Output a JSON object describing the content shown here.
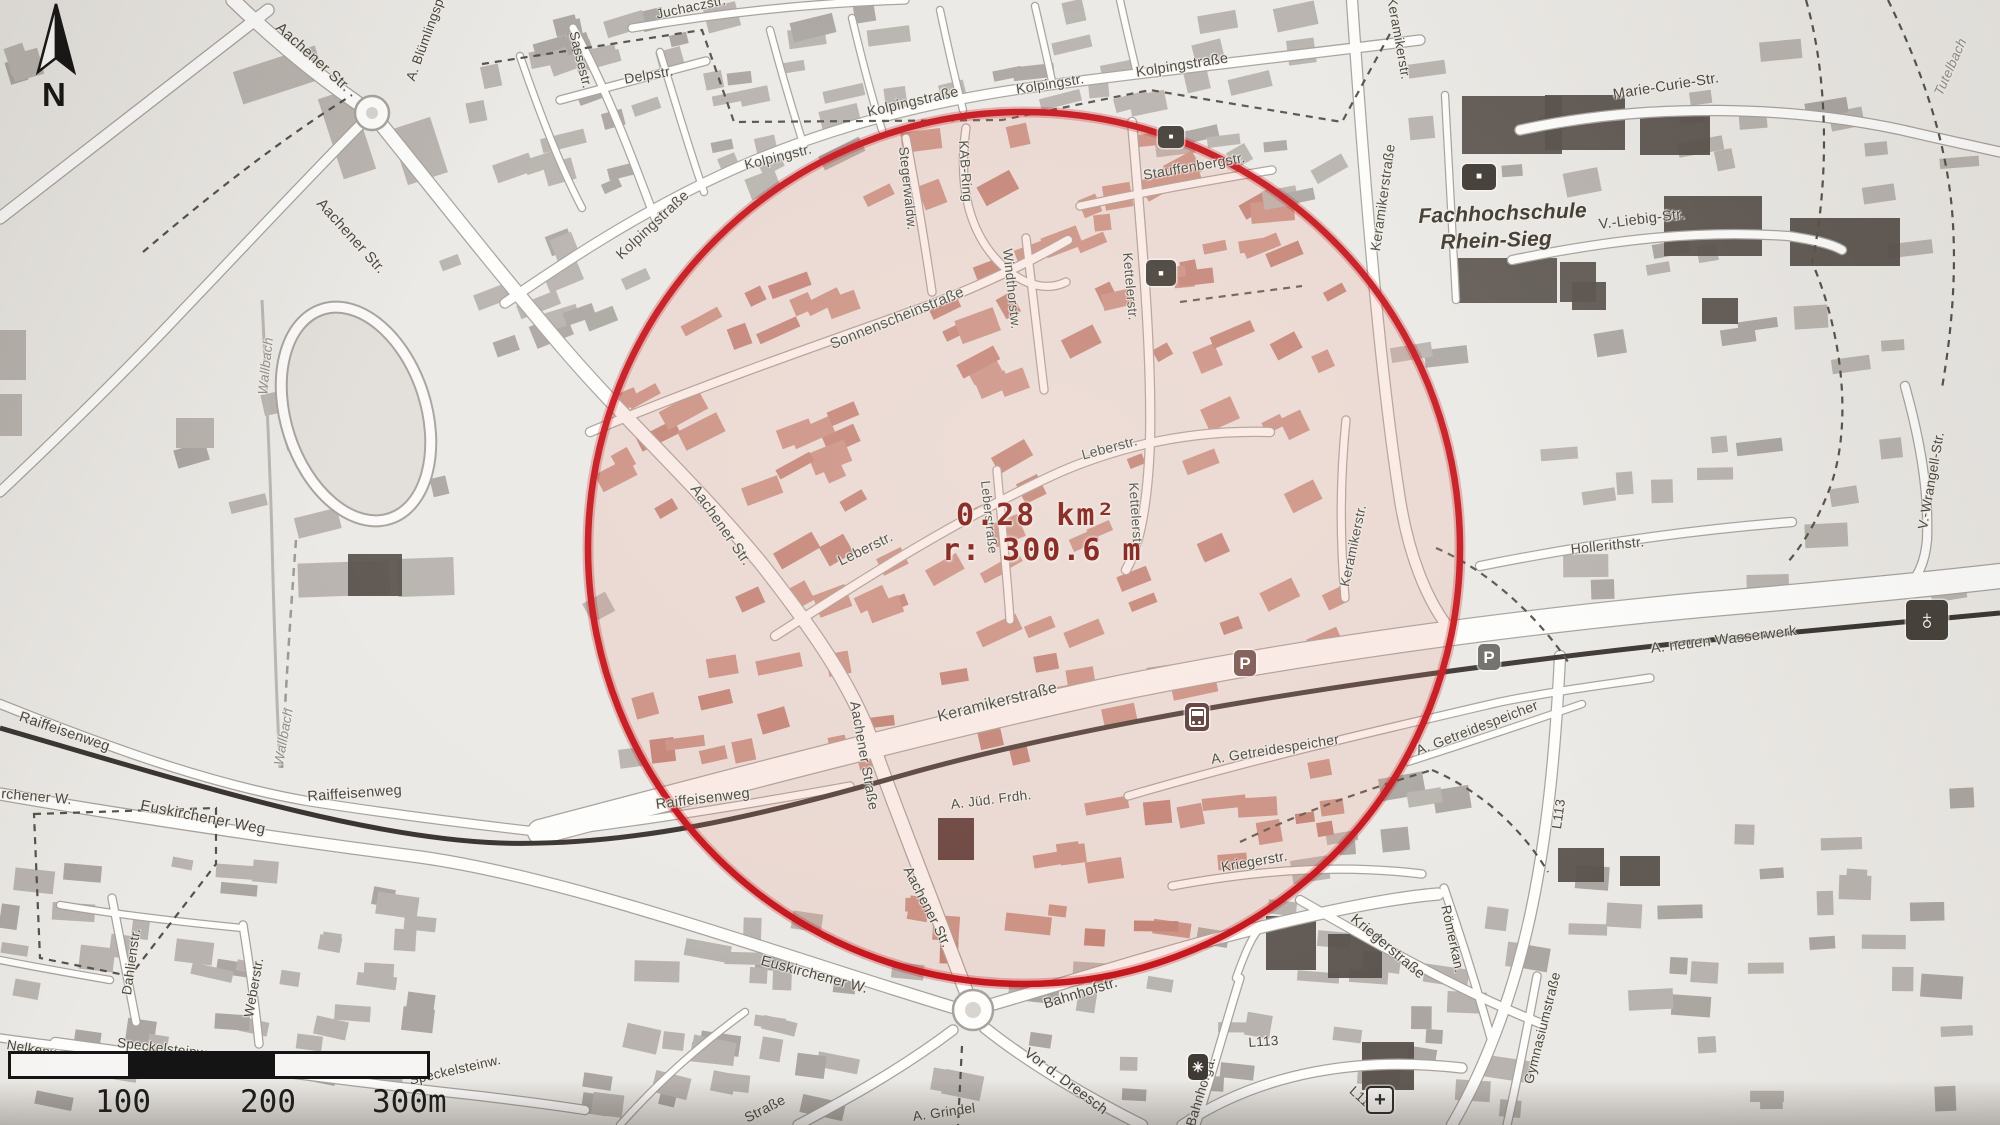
{
  "measurement": {
    "area": "0.28 km²",
    "radius": "r: 300.6 m"
  },
  "scale_bar": {
    "labels": [
      "100",
      "200",
      "300m"
    ]
  },
  "compass": {
    "label": "N"
  },
  "colors": {
    "circle_stroke": "#c4151c",
    "circle_tint": "rgba(231,138,115,0.17)",
    "measurement_text": "#7c130e",
    "railway": "#3b3531",
    "road_casing": "#a8a29c",
    "building_inside": "#c79387",
    "building_outside": "#b8b3ae",
    "building_dark": "#57504a"
  },
  "map_labels": [
    {
      "t": "Aachener Str.",
      "x": 283,
      "y": 20,
      "r": 42,
      "s": 15
    },
    {
      "t": "A. Blümlingspd.",
      "x": 404,
      "y": 78,
      "r": -70,
      "s": 13.5
    },
    {
      "t": "Juchaczstr.",
      "x": 655,
      "y": 8,
      "r": -12,
      "s": 13.5
    },
    {
      "t": "Sassestr.",
      "x": 580,
      "y": 30,
      "r": 76,
      "s": 13.5
    },
    {
      "t": "Delpstr.",
      "x": 623,
      "y": 72,
      "r": -10,
      "s": 14
    },
    {
      "t": "Aachener Str.",
      "x": 325,
      "y": 196,
      "r": 48,
      "s": 15
    },
    {
      "t": "Kolpingstraße",
      "x": 614,
      "y": 252,
      "r": -43,
      "s": 14.5
    },
    {
      "t": "Kolpingstr.",
      "x": 743,
      "y": 158,
      "r": -14,
      "s": 14
    },
    {
      "t": "Kolpingstraße",
      "x": 866,
      "y": 106,
      "r": -13,
      "s": 14.5
    },
    {
      "t": "Kolpingstr.",
      "x": 1015,
      "y": 82,
      "r": -9,
      "s": 14
    },
    {
      "t": "Kolpingstraße",
      "x": 1135,
      "y": 66,
      "r": -9,
      "s": 14.5
    },
    {
      "t": "Stegerwaldw.",
      "x": 910,
      "y": 146,
      "r": 84,
      "s": 13.5
    },
    {
      "t": "KAB-Ring",
      "x": 970,
      "y": 140,
      "r": 86,
      "s": 13.5
    },
    {
      "t": "Windthorstw.",
      "x": 1014,
      "y": 248,
      "r": 84,
      "s": 13.5
    },
    {
      "t": "Kettelerstr.",
      "x": 1134,
      "y": 252,
      "r": 85,
      "s": 13.5
    },
    {
      "t": "Stauffenbergstr.",
      "x": 1142,
      "y": 168,
      "r": -10,
      "s": 14
    },
    {
      "t": "Sonnenscheinstraße",
      "x": 828,
      "y": 338,
      "r": -22,
      "s": 15
    },
    {
      "t": "Leberstr.",
      "x": 1080,
      "y": 448,
      "r": -15,
      "s": 14
    },
    {
      "t": "Leberstraße",
      "x": 992,
      "y": 480,
      "r": 84,
      "s": 13
    },
    {
      "t": "Kettelerstr.",
      "x": 1140,
      "y": 482,
      "r": 86,
      "s": 13.5
    },
    {
      "t": "Leberstr.",
      "x": 836,
      "y": 556,
      "r": -26,
      "s": 14.5
    },
    {
      "t": "Aachener Str.",
      "x": 700,
      "y": 482,
      "r": 55,
      "s": 15
    },
    {
      "t": "Keramikerstr.",
      "x": 1338,
      "y": 585,
      "r": -78,
      "s": 13.5
    },
    {
      "t": "Keramikerstraße",
      "x": 936,
      "y": 710,
      "r": -14,
      "s": 16
    },
    {
      "t": "Keramikerstraße",
      "x": 1368,
      "y": 250,
      "r": -82,
      "s": 14
    },
    {
      "t": "Keramikerstr.",
      "x": 1398,
      "y": -4,
      "r": 80,
      "s": 13.5
    },
    {
      "t": "Marie-Curie-Str.",
      "x": 1612,
      "y": 88,
      "r": -9,
      "s": 14.5
    },
    {
      "t": "V.-Liebig-Str.",
      "x": 1598,
      "y": 218,
      "r": -7,
      "s": 14.5
    },
    {
      "t": "Tutelbach",
      "x": 1932,
      "y": 92,
      "r": -66,
      "s": 13.5,
      "c": "stream"
    },
    {
      "t": "Fachhochschule",
      "x": 1418,
      "y": 206,
      "r": -2,
      "s": 21,
      "c": "fh"
    },
    {
      "t": "Rhein-Sieg",
      "x": 1440,
      "y": 232,
      "r": -2,
      "s": 21,
      "c": "fh"
    },
    {
      "t": "Hollerithstr.",
      "x": 1570,
      "y": 542,
      "r": -6,
      "s": 14
    },
    {
      "t": "V.-Wrangell-Str.",
      "x": 1916,
      "y": 528,
      "r": -80,
      "s": 13.5
    },
    {
      "t": "A. neuen Wasserwerk",
      "x": 1650,
      "y": 642,
      "r": -7,
      "s": 14.5
    },
    {
      "t": "Wallbach",
      "x": 256,
      "y": 394,
      "r": -84,
      "s": 13.5,
      "c": "stream"
    },
    {
      "t": "Wallbach",
      "x": 272,
      "y": 764,
      "r": -80,
      "s": 13.5,
      "c": "stream"
    },
    {
      "t": "Raiffeisenweg",
      "x": 22,
      "y": 710,
      "r": 19,
      "s": 14.5
    },
    {
      "t": "Raiffeisenweg",
      "x": 307,
      "y": 790,
      "r": -4,
      "s": 14.5
    },
    {
      "t": "Raiffeisenweg",
      "x": 655,
      "y": 798,
      "r": -7,
      "s": 14.5
    },
    {
      "t": "Euskirchener Weg",
      "x": 142,
      "y": 798,
      "r": 11,
      "s": 15
    },
    {
      "t": "rchener W.",
      "x": 2,
      "y": 786,
      "r": 5,
      "s": 14
    },
    {
      "t": "Euskirchener W.",
      "x": 763,
      "y": 954,
      "r": 15,
      "s": 14.5
    },
    {
      "t": "Aachener Straße",
      "x": 862,
      "y": 700,
      "r": 80,
      "s": 14
    },
    {
      "t": "Aachener Str.",
      "x": 914,
      "y": 864,
      "r": 63,
      "s": 14
    },
    {
      "t": "A. Jüd. Frdh.",
      "x": 950,
      "y": 798,
      "r": -7,
      "s": 13.5
    },
    {
      "t": "A. Getreidespeicher",
      "x": 1210,
      "y": 752,
      "r": -9,
      "s": 14
    },
    {
      "t": "A. Getreidespeicher",
      "x": 1414,
      "y": 744,
      "r": -21,
      "s": 14
    },
    {
      "t": "Bahnhofstr.",
      "x": 1042,
      "y": 998,
      "r": -17,
      "s": 14.5
    },
    {
      "t": "Vor d. Dreesch",
      "x": 1030,
      "y": 1046,
      "r": 37,
      "s": 14.5
    },
    {
      "t": "Bahnhofga.",
      "x": 1184,
      "y": 1124,
      "r": -73,
      "s": 13.5
    },
    {
      "t": "A. Grindel",
      "x": 912,
      "y": 1110,
      "r": -8,
      "s": 13.5
    },
    {
      "t": "Straße",
      "x": 742,
      "y": 1112,
      "r": -27,
      "s": 14
    },
    {
      "t": "Kriegerstr.",
      "x": 1220,
      "y": 860,
      "r": -10,
      "s": 14
    },
    {
      "t": "Kriegerstraße",
      "x": 1357,
      "y": 912,
      "r": 40,
      "s": 14.5
    },
    {
      "t": "Römerkan.",
      "x": 1452,
      "y": 904,
      "r": 78,
      "s": 13.5
    },
    {
      "t": "Gymnasiumstraße",
      "x": 1522,
      "y": 1082,
      "r": -76,
      "s": 13.5
    },
    {
      "t": "L113",
      "x": 1248,
      "y": 1036,
      "r": -4,
      "s": 13.5
    },
    {
      "t": "L113",
      "x": 1356,
      "y": 1084,
      "r": 42,
      "s": 13.5
    },
    {
      "t": "L113",
      "x": 1550,
      "y": 828,
      "r": -82,
      "s": 13.5
    },
    {
      "t": "Dahlienstr.",
      "x": 120,
      "y": 994,
      "r": -82,
      "s": 13.5
    },
    {
      "t": "Weberstr.",
      "x": 242,
      "y": 1016,
      "r": -80,
      "s": 13.5
    },
    {
      "t": "Nelkenw.",
      "x": 8,
      "y": 1038,
      "r": 10,
      "s": 13.5
    },
    {
      "t": "Speckelsteinw.",
      "x": 118,
      "y": 1036,
      "r": 7,
      "s": 13.5
    },
    {
      "t": "Speckelsteinw.",
      "x": 408,
      "y": 1074,
      "r": -13,
      "s": 13.5
    }
  ],
  "poi_icons": [
    {
      "name": "tram-stop-icon",
      "x": 1185,
      "y": 703,
      "w": 24,
      "h": 28,
      "bg": "#5d3a38",
      "tram": true
    },
    {
      "name": "parking-icon-inner",
      "x": 1234,
      "y": 650,
      "w": 22,
      "h": 26,
      "bg": "#7c5650",
      "g": "P",
      "fs": 17
    },
    {
      "name": "parking-icon-outer",
      "x": 1478,
      "y": 644,
      "w": 22,
      "h": 26,
      "bg": "#6e6c68",
      "g": "P",
      "fs": 17
    },
    {
      "name": "church-icon",
      "x": 1906,
      "y": 600,
      "w": 42,
      "h": 40,
      "bg": "#454039",
      "g": "♁",
      "fs": 28
    },
    {
      "name": "flower-icon",
      "x": 1188,
      "y": 1054,
      "w": 20,
      "h": 26,
      "bg": "#3f3a33",
      "g": "✳",
      "fs": 14
    },
    {
      "name": "hospital-icon",
      "x": 1366,
      "y": 1086,
      "w": 24,
      "h": 24,
      "bg": "#f7f6f4",
      "g": "+",
      "fs": 20,
      "fg": "#2d2a26",
      "bd": "#2d2a26"
    },
    {
      "name": "poi-icon-campus",
      "x": 1462,
      "y": 164,
      "w": 34,
      "h": 26,
      "bg": "#3f3a33",
      "g": "■",
      "fs": 10
    },
    {
      "name": "poi-icon-1",
      "x": 1158,
      "y": 126,
      "w": 26,
      "h": 22,
      "bg": "#433d36",
      "g": "■",
      "fs": 8
    },
    {
      "name": "poi-icon-2",
      "x": 1146,
      "y": 260,
      "w": 30,
      "h": 26,
      "bg": "#433d36",
      "g": "■",
      "fs": 9
    }
  ]
}
